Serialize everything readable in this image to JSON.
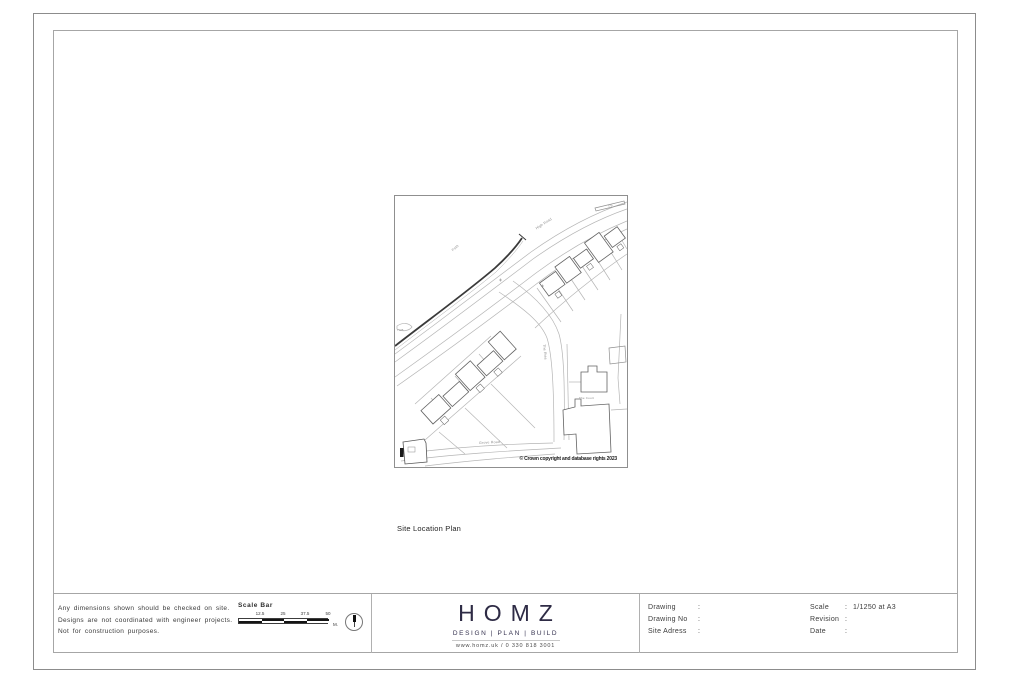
{
  "sheet": {
    "figure": {
      "caption": "Site Location Plan",
      "map": {
        "copyright": "© Crown copyright and database rights 2023",
        "labels": [
          {
            "text": "High Road"
          },
          {
            "text": "Path"
          },
          {
            "text": "The Rise"
          },
          {
            "text": "Grove Road"
          },
          {
            "text": "The Court"
          },
          {
            "text": "FB"
          },
          {
            "text": "TCB"
          }
        ]
      }
    },
    "notes": {
      "lines": [
        "Any dimensions shown should be checked on site.",
        "Designs are not coordinated with engineer projects.",
        "Not for construction purposes."
      ]
    },
    "scale_bar": {
      "title": "Scale Bar",
      "ticks": [
        "12.5",
        "25",
        "37.5",
        "50"
      ],
      "unit": "M."
    },
    "logo": {
      "name": "HOMZ",
      "tagline": "DESIGN | PLAN | BUILD",
      "contact": "www.homz.uk / 0 330 818 3001",
      "brand_color": "#2e2b45"
    },
    "title_block": {
      "sep": ":",
      "left_fields": [
        {
          "label": "Drawing",
          "value": ""
        },
        {
          "label": "Drawing No",
          "value": ""
        },
        {
          "label": "Site Adress",
          "value": ""
        }
      ],
      "right_fields": [
        {
          "label": "Scale",
          "value": "1/1250 at A3"
        },
        {
          "label": "Revision",
          "value": ""
        },
        {
          "label": "Date",
          "value": ""
        }
      ]
    }
  }
}
